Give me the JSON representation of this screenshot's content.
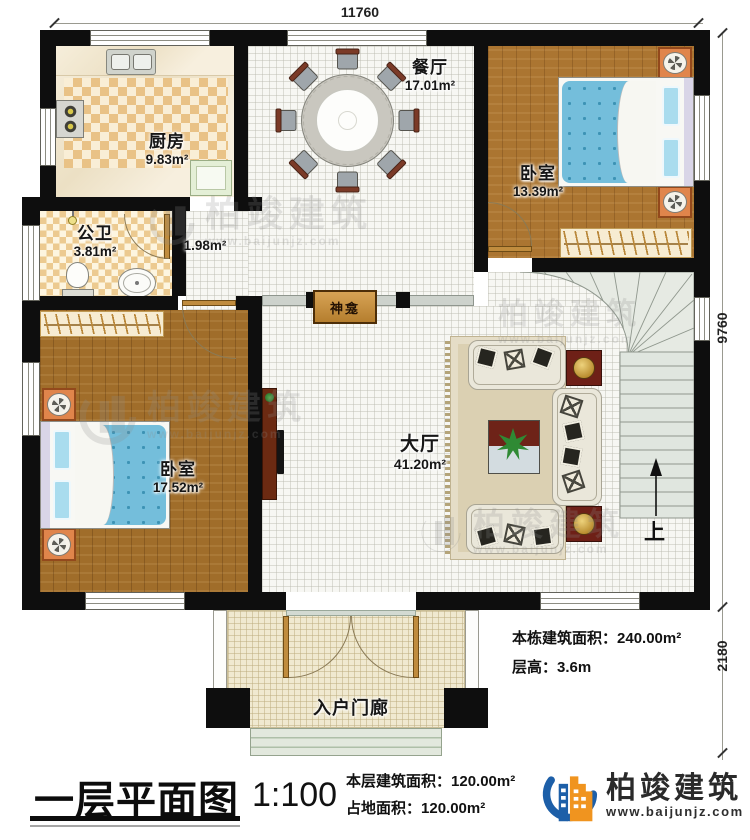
{
  "dimensions": {
    "top": "11760",
    "right_upper": "9760",
    "right_lower": "2180"
  },
  "rooms": {
    "kitchen": {
      "name": "厨房",
      "area": "9.83m²"
    },
    "bathroom": {
      "name": "公卫",
      "area": "3.81m²"
    },
    "passage": {
      "area": "1.98m²"
    },
    "dining": {
      "name": "餐厅",
      "area": "17.01m²"
    },
    "bedroom_top_right": {
      "name": "卧室",
      "area": "13.39m²"
    },
    "bedroom_left": {
      "name": "卧室",
      "area": "17.52m²"
    },
    "hall": {
      "name": "大厅",
      "area": "41.20m²"
    },
    "porch": {
      "name": "入户门廊"
    },
    "shrine": {
      "name": "神龛"
    }
  },
  "stairs": {
    "direction_label": "上"
  },
  "annotations": {
    "building_area_label": "本栋建筑面积：",
    "building_area_value": "240.00m²",
    "floor_height_label": "层高：",
    "floor_height_value": "3.6m"
  },
  "title_block": {
    "title": "一层平面图",
    "scale": "1:100",
    "floor_area_label": "本层建筑面积：",
    "floor_area_value": "120.00m²",
    "land_area_label": "占地面积：",
    "land_area_value": "120.00m²"
  },
  "brand": {
    "name": "柏竣建筑",
    "website": "www.baijunjz.com",
    "blue": "#1d5fa8",
    "orange": "#f0941f"
  }
}
